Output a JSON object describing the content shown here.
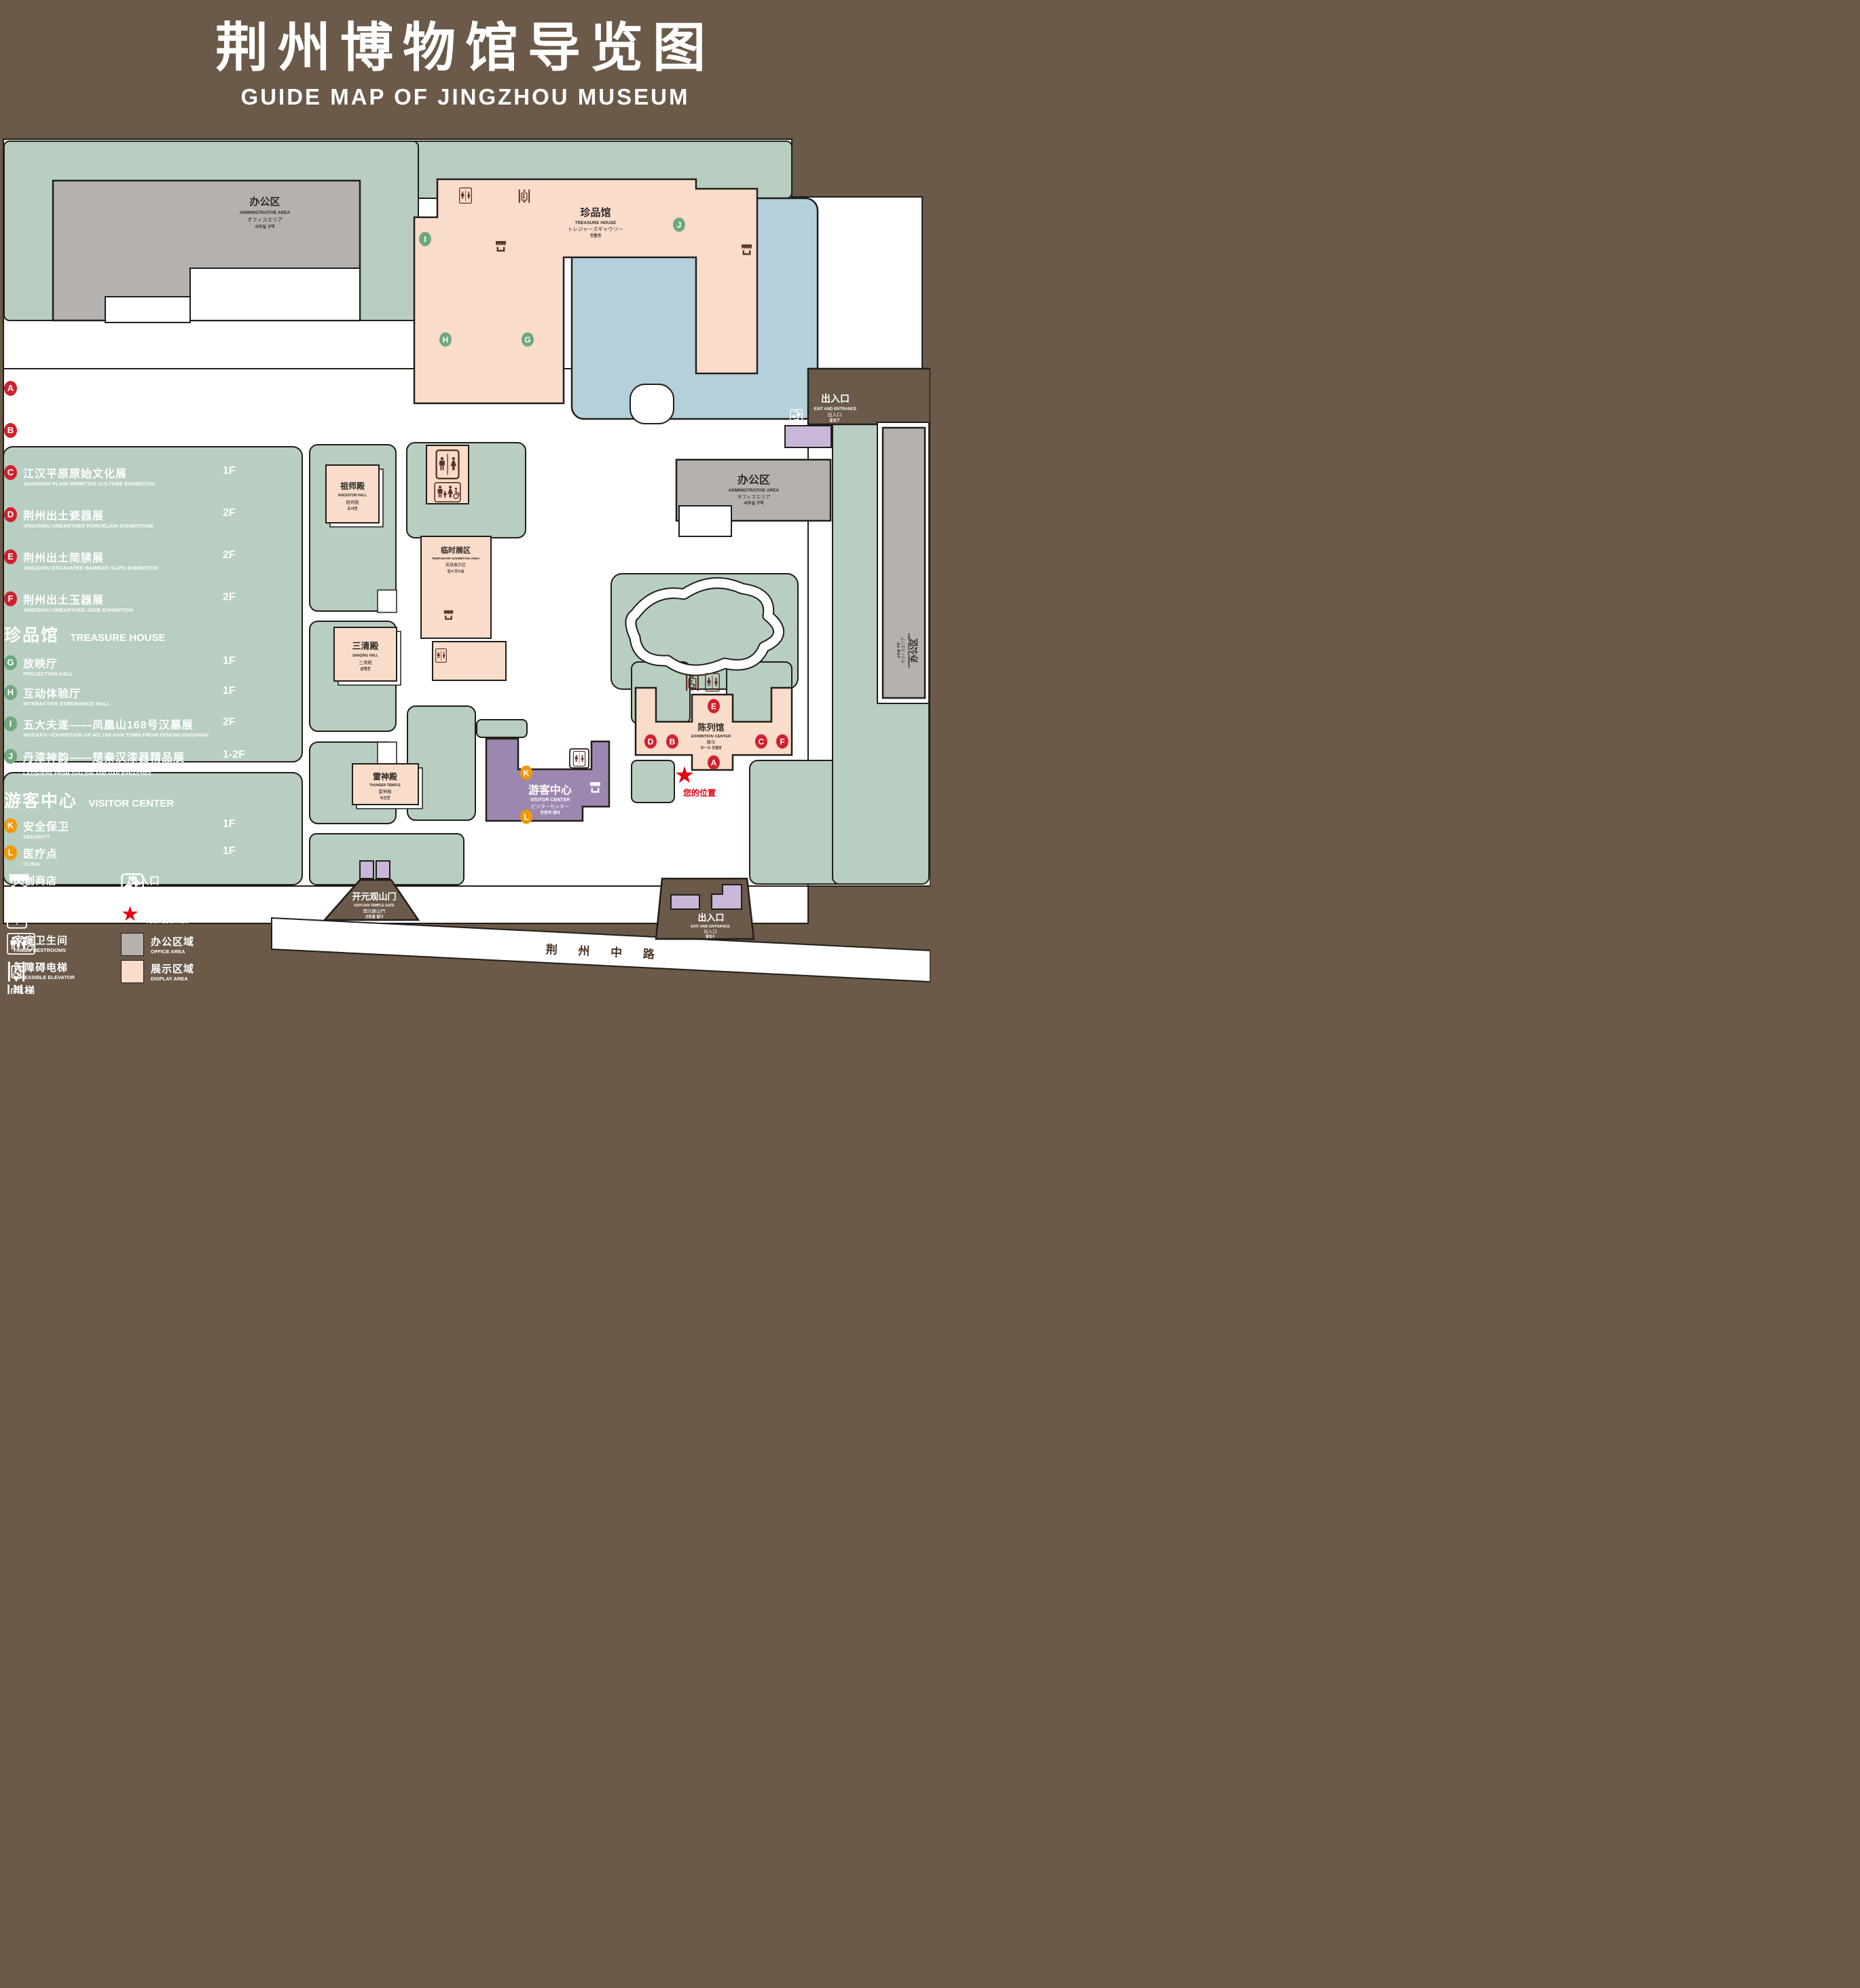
{
  "title": {
    "cn": "荆州博物馆导览图",
    "en": "GUIDE MAP OF JINGZHOU MUSEUM"
  },
  "badges": {
    "A": "A",
    "B": "B",
    "C": "C",
    "D": "D",
    "E": "E",
    "F": "F",
    "G": "G",
    "H": "H",
    "I": "I",
    "J": "J",
    "K": "K",
    "L": "L"
  },
  "colors": {
    "background": "#6b5949",
    "lawn": "#b7cec0",
    "display_area": "#fadccb",
    "office_area": "#b5b1af",
    "pond": "#b4d0da",
    "visitor_center": "#9c87b0",
    "lavender": "#c8b7d9",
    "badge_red": "#d0202e",
    "badge_green": "#6fa77f",
    "badge_orange": "#f39800",
    "location_red": "#e60012",
    "icon_brown": "#5d3126"
  },
  "legend": {
    "exhibition_header": {
      "cn": "陈列馆",
      "en": "EXHIBITION CENTER"
    },
    "treasure_header": {
      "cn": "珍品馆",
      "en": "TREASURE HOUSE"
    },
    "visitor_header": {
      "cn": "游客中心",
      "en": "VISITOR CENTER"
    },
    "items": {
      "A": {
        "cn": "《火中的凤凰》壁画",
        "en": "THE PHOENIX IN FIRE \"MURAL PAINTING",
        "floor": "1F"
      },
      "B": {
        "cn": "荆州出土铜器展",
        "en": "JINGZHOU UNEARTHED BRONZE WARE EXHIBITION",
        "floor": "1F"
      },
      "C": {
        "cn": "江汉平原原始文化展",
        "en": "JIANGHAN PLAIN PRIMITIVE CULTURE EXHIBITION",
        "floor": "1F"
      },
      "D": {
        "cn": "荆州出土瓷器展",
        "en": "JINGZHOU UNEARTHED PORCELAIN EXHIBITIONE",
        "floor": "2F"
      },
      "E": {
        "cn": "荆州出土简牍展",
        "en": "JINGZHOU EXCAVATED BAMBOO SLIPS EXHIBITION",
        "floor": "2F"
      },
      "F": {
        "cn": "荆州出土玉器展",
        "en": "JINGZHOU UNEARTHED JADE EXHIBITION",
        "floor": "2F"
      },
      "G": {
        "cn": "放映厅",
        "en": "PROJECTION HALL",
        "floor": "1F"
      },
      "H": {
        "cn": "互动体验厅",
        "en": "INTERACTIVE EXPERIENCE HALL",
        "floor": "1F"
      },
      "I": {
        "cn": "五大夫遂——凤凰山168号汉墓展",
        "en": "WUDAFU—EXHIBITION OF NO.168 HAN TOMB FROM FENGHUANGSHAN",
        "floor": "2F"
      },
      "J": {
        "cn": "丹漆神韵——楚秦汉漆器精品展",
        "en": "ROMANTIC CHARM OF THE CRIMSON LACQUERS—EXHIBITIONS OF FINE LACQUERS FROM CHU,QIN AND HAN DYNASTIES",
        "floor": "1-2F"
      },
      "K": {
        "cn": "安全保卫",
        "en": "SECURITY",
        "floor": "1F"
      },
      "L": {
        "cn": "医疗点",
        "en": "CLINIC",
        "floor": "1F"
      }
    },
    "facilities": {
      "store": {
        "cn": "文创商店",
        "en": "STORE"
      },
      "restrooms": {
        "cn": "卫生间",
        "en": "RESTROOMS"
      },
      "family_restrooms": {
        "cn": "家庭卫生间",
        "en": "FAMILY RESTROOMS"
      },
      "accessible_elevator": {
        "cn": "无障碍电梯",
        "en": "ACCESSIBLE ELEVATOR"
      },
      "elevator": {
        "cn": "电梯",
        "en": "Elevator"
      },
      "exit": {
        "cn": "出入口",
        "en": "EXIT AND ENTRANCE"
      },
      "your_location": {
        "cn": "您的位置",
        "en": "YOUR LOCATION"
      },
      "office_area": {
        "cn": "办公区域",
        "en": "OFFICE AREA"
      },
      "display_area": {
        "cn": "展示区域",
        "en": "DISPLAY AREA"
      }
    }
  },
  "map": {
    "admin_northwest": {
      "cn": "办公区",
      "en": "ADMINISTRATIVE AREA",
      "jp": "オフィスエリア",
      "kr": "사무실 구역"
    },
    "treasure_house": {
      "cn": "珍品馆",
      "en": "TREASURE HOUSE",
      "jp": "トレジャーズギャウリー",
      "kr": "진품관"
    },
    "ancestor_hall": {
      "cn": "祖师殿",
      "en": "ANCESTOR HALL",
      "jp": "祖师殿",
      "kr": "조사전"
    },
    "sanqing_hall": {
      "cn": "三清殿",
      "en": "SANQING HALL",
      "jp": "三清殿",
      "kr": "삼청전"
    },
    "thunder_temple": {
      "cn": "雷神殿",
      "en": "THUNDER TEMPLE",
      "jp": "雷神殿",
      "kr": "뇌신전"
    },
    "temporary_area": {
      "cn": "临时展区",
      "en": "TEMPORARY EXHIBITION AREA",
      "jp": "仮設展示区",
      "kr": "임시 전시실"
    },
    "admin_central": {
      "cn": "办公区",
      "en": "ADMINISTRATIVE AREA",
      "jp": "オフィスエリア",
      "kr": "사무실 구역"
    },
    "admin_east": {
      "cn": "办公区",
      "en": "ADMINISTRATIVE AREA",
      "jp": "オフィスエリア",
      "kr": "사무실 구역"
    },
    "exhibition_center": {
      "cn": "陈列馆",
      "en": "EXHIBITION CENTER",
      "jp": "展示",
      "kr": "ホール 진열관"
    },
    "visitor_center": {
      "cn": "游客中心",
      "en": "VISITOR CENTER",
      "jp": "ビジターセンター",
      "kr": "관광객 센터"
    },
    "exit_east": {
      "cn": "出入口",
      "en": "EXIT AND ENTRANCE",
      "jp": "出入口",
      "kr": "출입구"
    },
    "exit_south": {
      "cn": "出入口",
      "en": "EXIT AND ENTRANCE",
      "jp": "出入口",
      "kr": "출입구"
    },
    "gate": {
      "cn": "开元观山门",
      "en": "KAIYUAN TEMPLE GATE",
      "jp": "開元観山門",
      "kr": "산문을 열다"
    },
    "road": {
      "cn": "荆 州 中 路"
    },
    "your_location": {
      "cn": "您的位置"
    }
  }
}
